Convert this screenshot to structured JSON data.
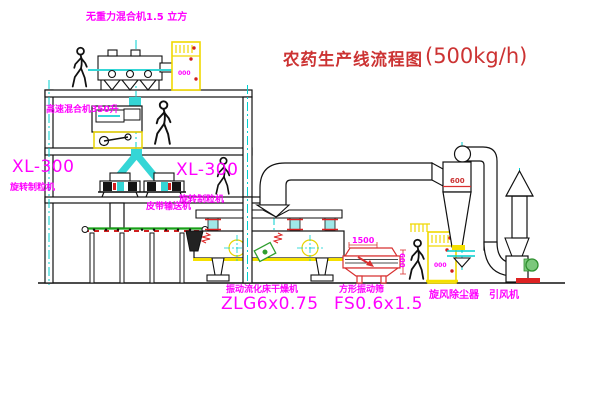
{
  "diagram": {
    "title": {
      "text": "农药生产线流程图",
      "capacity": "(500kg/h)"
    },
    "equipment": {
      "gravity_mixer": {
        "label": "无重力混合机1.5 立方"
      },
      "high_speed_mixer": {
        "label": "高速混合机350升"
      },
      "granulator_left": {
        "model": "XL-300",
        "label": "旋转制粒机"
      },
      "granulator_right": {
        "model": "XL-300",
        "label": "旋转制粒机"
      },
      "belt_conveyor": {
        "label": "皮带输送机"
      },
      "fluid_bed_dryer": {
        "label": "振动流化床干燥机",
        "model": "ZLG6x0.75"
      },
      "square_sieve": {
        "label": "方形振动筛",
        "model": "FS0.6x1.5",
        "dim_length": "1500",
        "dim_width": "600"
      },
      "cyclone": {
        "label": "旋风除尘器",
        "dim_diameter": "600"
      },
      "induced_draft_fan": {
        "label": "引风机"
      },
      "control_panel_1": {
        "display": "000"
      },
      "control_panel_2": {
        "display": "000"
      }
    },
    "colors": {
      "label_magenta": "#ff00ff",
      "title_red": "#cc3333",
      "centerline_cyan": "#00cfcf",
      "cabinet_yellow": "#f0d800",
      "machine_red": "#d83030",
      "motor_green": "#2f9e2f"
    }
  }
}
